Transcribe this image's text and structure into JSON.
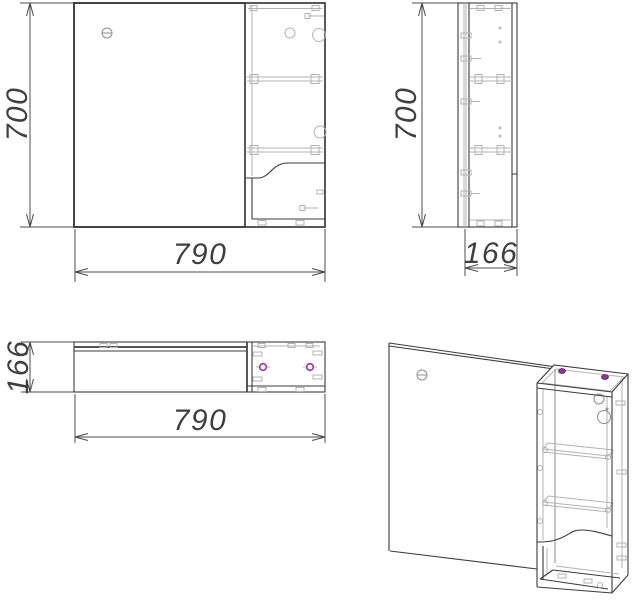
{
  "document": {
    "kind": "technical-drawing",
    "background": "#ffffff"
  },
  "views": {
    "front": {
      "height_label": "700",
      "width_label": "790"
    },
    "side": {
      "height_label": "700",
      "depth_label": "166"
    },
    "top": {
      "depth_label": "166",
      "width_label": "790"
    },
    "isometric": {
      "label": ""
    }
  },
  "colors": {
    "outline": "#3b3b3b",
    "dimension": "#4c4c4c",
    "detail": "#b3b3b3",
    "screw_accent": "#993399",
    "background": "#ffffff"
  }
}
